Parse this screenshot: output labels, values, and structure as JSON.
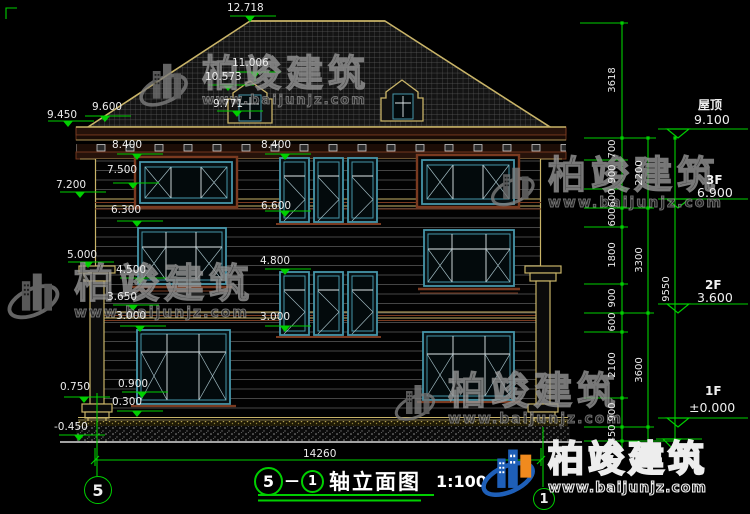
{
  "drawing": {
    "title": "轴立面图",
    "scale": "1:100",
    "axis_start": "5",
    "axis_end": "1",
    "title_separator": "—",
    "overall_width_dim": "14260",
    "axis_bubble_left": "5",
    "axis_bubble_right": "1"
  },
  "levels": [
    {
      "name": "屋顶",
      "value": "9.100"
    },
    {
      "name": "3F",
      "value": "6.900"
    },
    {
      "name": "2F",
      "value": "3.600"
    },
    {
      "name": "1F",
      "value": "±0.000"
    }
  ],
  "marks": [
    {
      "v": "12.718"
    },
    {
      "v": "11.006"
    },
    {
      "v": "10.573"
    },
    {
      "v": "9.771"
    },
    {
      "v": "9.600"
    },
    {
      "v": "9.450"
    },
    {
      "v": "8.400"
    },
    {
      "v": "8.400"
    },
    {
      "v": "7.500"
    },
    {
      "v": "7.200"
    },
    {
      "v": "6.600"
    },
    {
      "v": "6.300"
    },
    {
      "v": "5.000"
    },
    {
      "v": "4.800"
    },
    {
      "v": "4.500"
    },
    {
      "v": "3.650"
    },
    {
      "v": "3.000"
    },
    {
      "v": "3.000"
    },
    {
      "v": "0.750"
    },
    {
      "v": "0.900"
    },
    {
      "v": "0.300"
    },
    {
      "v": "-0.450"
    }
  ],
  "chains": {
    "inner": [
      "3618",
      "700",
      "900",
      "600",
      "600",
      "1800",
      "900",
      "600",
      "2100",
      "900",
      "450"
    ],
    "middle": [
      "2200",
      "3300",
      "3600"
    ],
    "outer": [
      "9550"
    ]
  },
  "watermark": {
    "brand": "柏竣建筑",
    "url": "www.baijunjz.com"
  },
  "colors": {
    "dim_green": "#00cf00",
    "line_tan": "#c9b468",
    "window_teal": "#4696aa",
    "trim_brown": "#7a3a20",
    "logo_blue": "#1e5fb8",
    "logo_orange": "#f08a1e"
  }
}
